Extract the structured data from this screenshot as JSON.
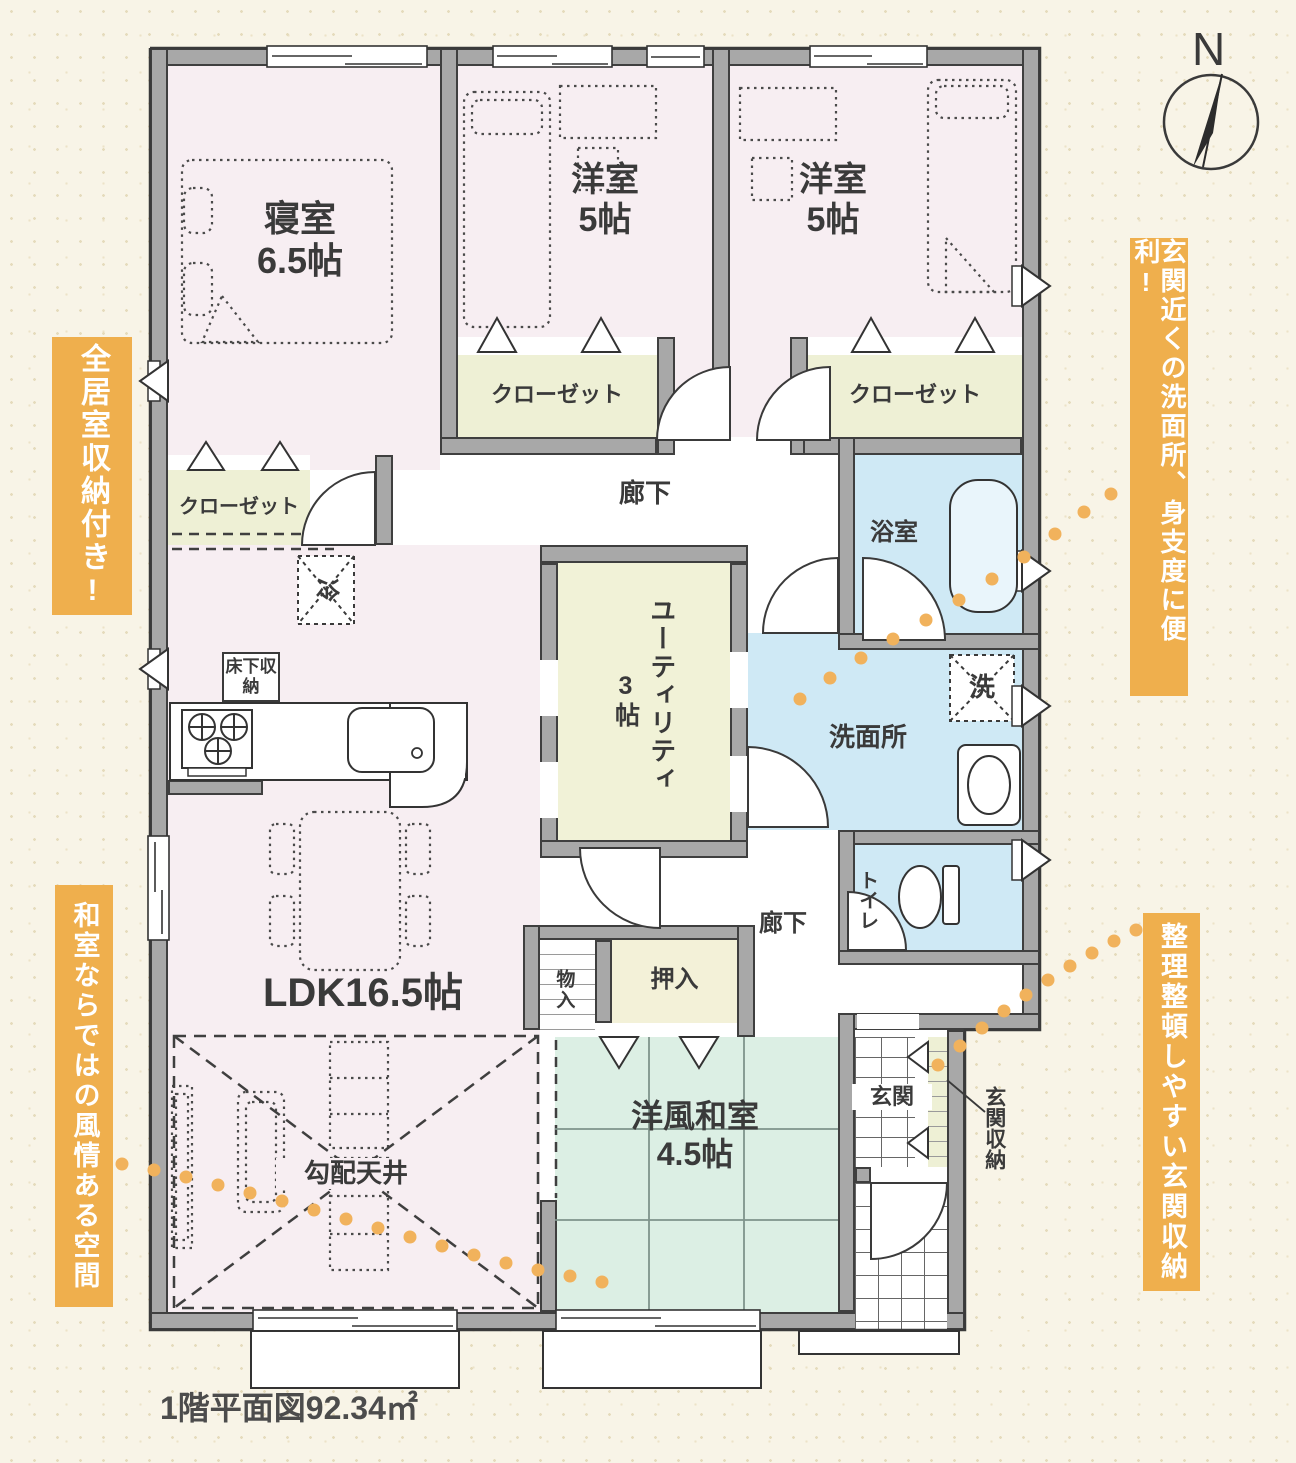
{
  "caption": "1階平面図92.34㎡",
  "compass_n": "N",
  "labels": {
    "bedroom_name": "寝室",
    "bedroom_size": "6.5帖",
    "western_name": "洋室",
    "western_size": "5帖",
    "closet": "クローゼット",
    "hallway": "廊下",
    "bath": "浴室",
    "utility_name": "ユーティリティ",
    "utility_size": "3帖",
    "washroom": "洗面所",
    "washer": "洗",
    "fridge": "冷",
    "floor_storage": "床下収納",
    "ldk": "LDK16.5帖",
    "sloped_ceiling": "勾配天井",
    "storage_small": "物入",
    "oshiire": "押入",
    "toilet": "トイレ",
    "tatami_name": "洋風和室",
    "tatami_size": "4.5帖",
    "entrance": "玄関",
    "entrance_storage": "玄関収納"
  },
  "callouts": {
    "left_top": "全居室収納付き!",
    "left_bottom": "和室ならではの風情ある空間",
    "right_top": "玄関近くの洗面所、身支度に便利!",
    "right_bottom": "整理整頓しやすい玄関収納"
  },
  "colors": {
    "background": "#f8f4e7",
    "wall_gray": "#a8a8a8",
    "accent_orange": "#efaf4d",
    "room_pink": "#f7eef2",
    "water_blue": "#cfe9f5",
    "closet_green": "#eef0d5",
    "tatami_green": "#dcefe4"
  }
}
